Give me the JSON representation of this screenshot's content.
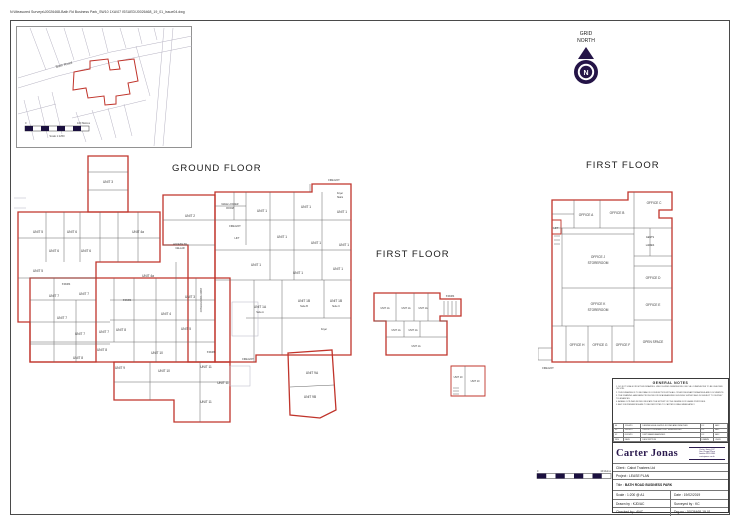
{
  "sheet": {
    "file_path": "N:\\Measured Surveys\\J0026468-Bath Rd Business Park_SW10 1XA\\07 ISSUED\\J0026468_19_01_Issue04.dwg"
  },
  "north_indicator": {
    "line1": "GRID",
    "line2": "NORTH",
    "letter": "N"
  },
  "location_map": {
    "road_label": "Bath Road",
    "scale_left": "0",
    "scale_right": "100 Metres",
    "scale_caption": "Scale 1:1250"
  },
  "ground_floor": {
    "title": "GROUND FLOOR",
    "labels": [
      "UNIT 3",
      "UNIT 2",
      "UNIT 4a",
      "UNIT 6",
      "UNIT 5",
      "UNIT 6",
      "UNIT 6",
      "UNIT 4a",
      "UNIT 5",
      "STAIRS",
      "UNIT 7",
      "UNIT 7",
      "STAIRS",
      "UNIT 7",
      "UNIT 7",
      "UNIT 7",
      "UNIT 8",
      "UNIT 8",
      "UNIT 8",
      "UNIT 9",
      "UNIT 4",
      "UNIT 3",
      "UNIT 5",
      "UNIT 10",
      "UNIT 10",
      "STAIRS",
      "UNIT 11",
      "UNIT 11",
      "UNIT 11",
      "ACCESS TO",
      "CELLAR",
      "COVERED WALKWAY",
      "MALE LOCKER",
      "ROOM",
      "FIRE EXIT",
      "LIFT",
      "UNIT 1",
      "UNIT 1",
      "UNIT 1",
      "UNIT 1",
      "UNIT 1",
      "UNIT 1",
      "Foyer",
      "Stairs",
      "FIRE EXIT",
      "UNIT 1",
      "UNIT 1",
      "UNIT 1",
      "UNIT 1A",
      "Suite A",
      "UNIT 1B",
      "Suite B",
      "UNIT 1B",
      "Suite C",
      "Foyer",
      "FIRE EXIT",
      "UNIT 9A",
      "UNIT 9B"
    ]
  },
  "first_floor_mid": {
    "title": "FIRST FLOOR",
    "labels": [
      "UNIT 1A",
      "UNIT 1A",
      "UNIT 1A",
      "STAIRS",
      "UNIT 1A",
      "UNIT 1A",
      "UNIT 1A"
    ]
  },
  "unit10_block": {
    "labels": [
      "UNIT 10",
      "UNIT 10"
    ]
  },
  "first_floor_right": {
    "title": "FIRST FLOOR",
    "labels": [
      "OFFICE A",
      "OFFICE B",
      "OFFICE C",
      "LIFT",
      "GENTS",
      "LADIES",
      "OFFICE J",
      "STOREROOM",
      "OFFICE K",
      "STOREROOM",
      "OFFICE D",
      "OFFICE E",
      "OFFICE H",
      "OFFICE G",
      "OFFICE F",
      "OPEN SPACE",
      "FIRE EXIT"
    ]
  },
  "main_scale_bar": {
    "left": "0",
    "right": "10 Metres"
  },
  "title_block": {
    "general_notes_title": "GENERAL NOTES",
    "notes": [
      "1. DO NOT SCALE FROM THIS DRAWING. USE FIGURED DIMENSIONS ONLY. ALL DIMENSIONS TO BE CHECKED ON SITE.",
      "2. THIS DRAWING IS TO BE READ IN CONJUNCTION WITH ALL OTHER RELEVANT DRAWINGS AND DOCUMENTS.",
      "3. THE DRAWING HAS BEEN PRODUCED FROM A MEASURED BUILDING SURVEY AND IS SUBJECT TO SURVEY TOLERANCES.",
      "4. AREAS OUTLINED IN RED INDICATE THE EXTENT OF THE DEMISE FOR LEASE PURPOSES.",
      "5. ANY DISCREPANCIES ARE TO BE REPORTED TO CARTER JONAS IMMEDIATELY."
    ],
    "revisions": {
      "header": [
        "REV",
        "DATE",
        "DESCRIPTION",
        "DRAWN",
        "CHKD"
      ],
      "rows": [
        [
          "04",
          "12/04/19",
          "DEMISE HIGHLIGHTED ROOMS AND REMOVED",
          "KC",
          "ANC"
        ],
        [
          "03",
          "28/03/19",
          "OFFICE TITLES AND TEXT HIGHLIGHTED",
          "KC",
          "ANC"
        ],
        [
          "02",
          "05/03/19",
          "UNIT NAMES AMENDED",
          "KC",
          "ANC"
        ]
      ]
    },
    "logo_text": "Carter Jonas",
    "address_lines": [
      "Carter Jonas LLP",
      "One Chapel Place",
      "London W1G 0BG",
      "carterjonas.co.uk"
    ],
    "client_label": "Client :",
    "client_value": "Cabot Trustees Ltd",
    "project_label": "Project :",
    "project_value": "LEASE PLAN",
    "title_label": "Title :",
    "title_value": "BATH ROAD BUSINESS PARK",
    "scale_label": "Scale :",
    "scale_value": "1:200 @ A1",
    "date_label": "Date :",
    "date_value": "19/02/2019",
    "drawn_label": "Drawn by :",
    "drawn_value": "KJD/AC",
    "surveyed_label": "Surveyed by :",
    "surveyed_value": "KC",
    "checked_label": "Checked by :",
    "checked_value": "ANC",
    "drg_label": "Drg no :",
    "drg_value": "J0026468-19-01"
  }
}
